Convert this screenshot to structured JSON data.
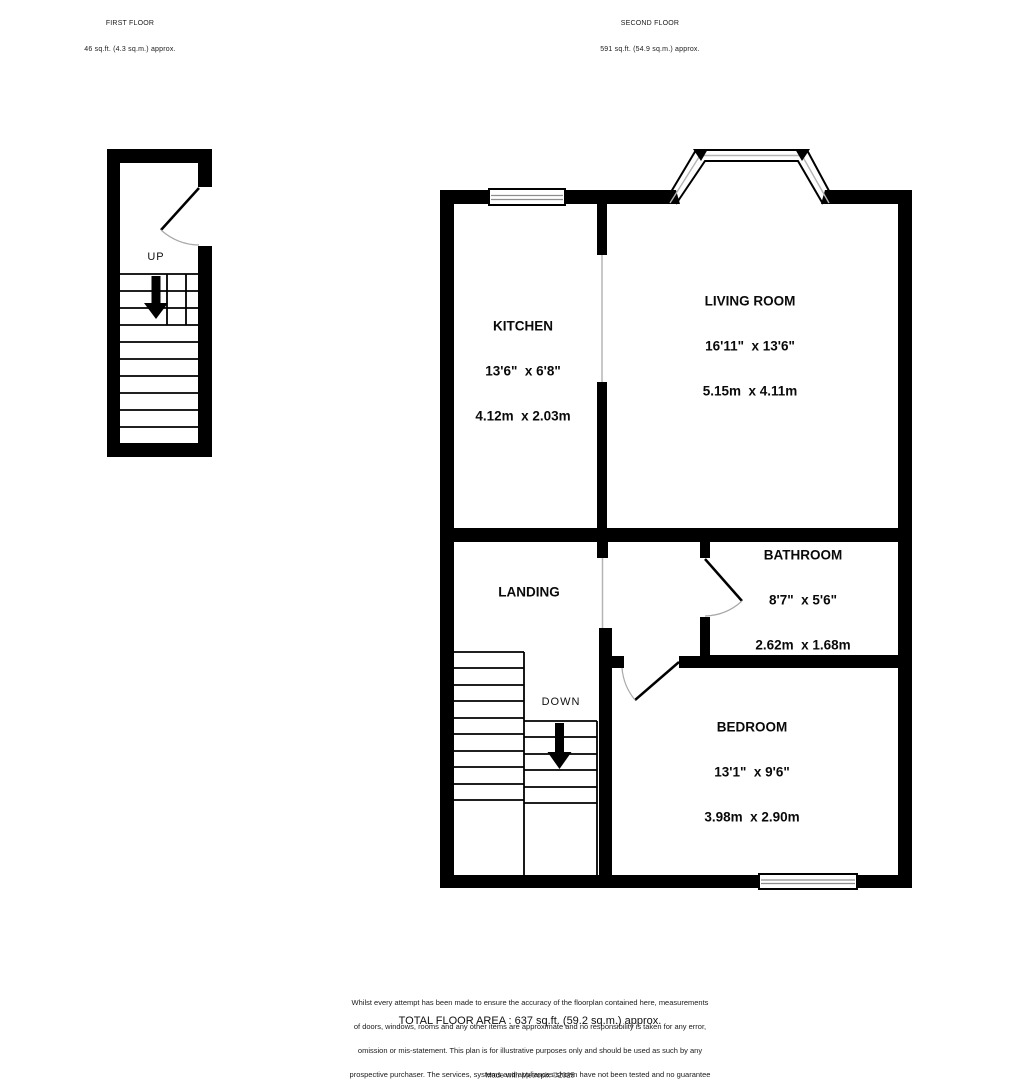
{
  "colors": {
    "wall": "#000000",
    "opening_line": "#b5b5b5",
    "door_arc": "#a8a8a8",
    "window_line": "#8d8d8d",
    "background": "#ffffff"
  },
  "first_floor": {
    "title": "FIRST FLOOR",
    "area": "46 sq.ft. (4.3 sq.m.) approx.",
    "stair_label": "UP"
  },
  "second_floor": {
    "title": "SECOND FLOOR",
    "area": "591 sq.ft. (54.9 sq.m.) approx.",
    "stair_label": "DOWN",
    "rooms": {
      "kitchen": {
        "name": "KITCHEN",
        "imperial": "13'6\"  x 6'8\"",
        "metric": "4.12m  x 2.03m"
      },
      "living_room": {
        "name": "LIVING ROOM",
        "imperial": "16'11\"  x 13'6\"",
        "metric": "5.15m  x 4.11m"
      },
      "landing": {
        "name": "LANDING"
      },
      "bathroom": {
        "name": "BATHROOM",
        "imperial": "8'7\"  x 5'6\"",
        "metric": "2.62m  x 1.68m"
      },
      "bedroom": {
        "name": "BEDROOM",
        "imperial": "13'1\"  x 9'6\"",
        "metric": "3.98m  x 2.90m"
      }
    }
  },
  "footer": {
    "total_area": "TOTAL FLOOR AREA : 637 sq.ft. (59.2 sq.m.) approx.",
    "disclaimer_lines": [
      "Whilst every attempt has been made to ensure the accuracy of the floorplan contained here, measurements",
      "of doors, windows, rooms and any other items are approximate and no responsibility is taken for any error,",
      "omission or mis-statement. This plan is for illustrative purposes only and should be used as such by any",
      "prospective purchaser. The services, systems and appliances shown have not been tested and no guarantee",
      "as to their operability or efficiency can be given."
    ],
    "credit": "Made with Metropix ©2025"
  }
}
